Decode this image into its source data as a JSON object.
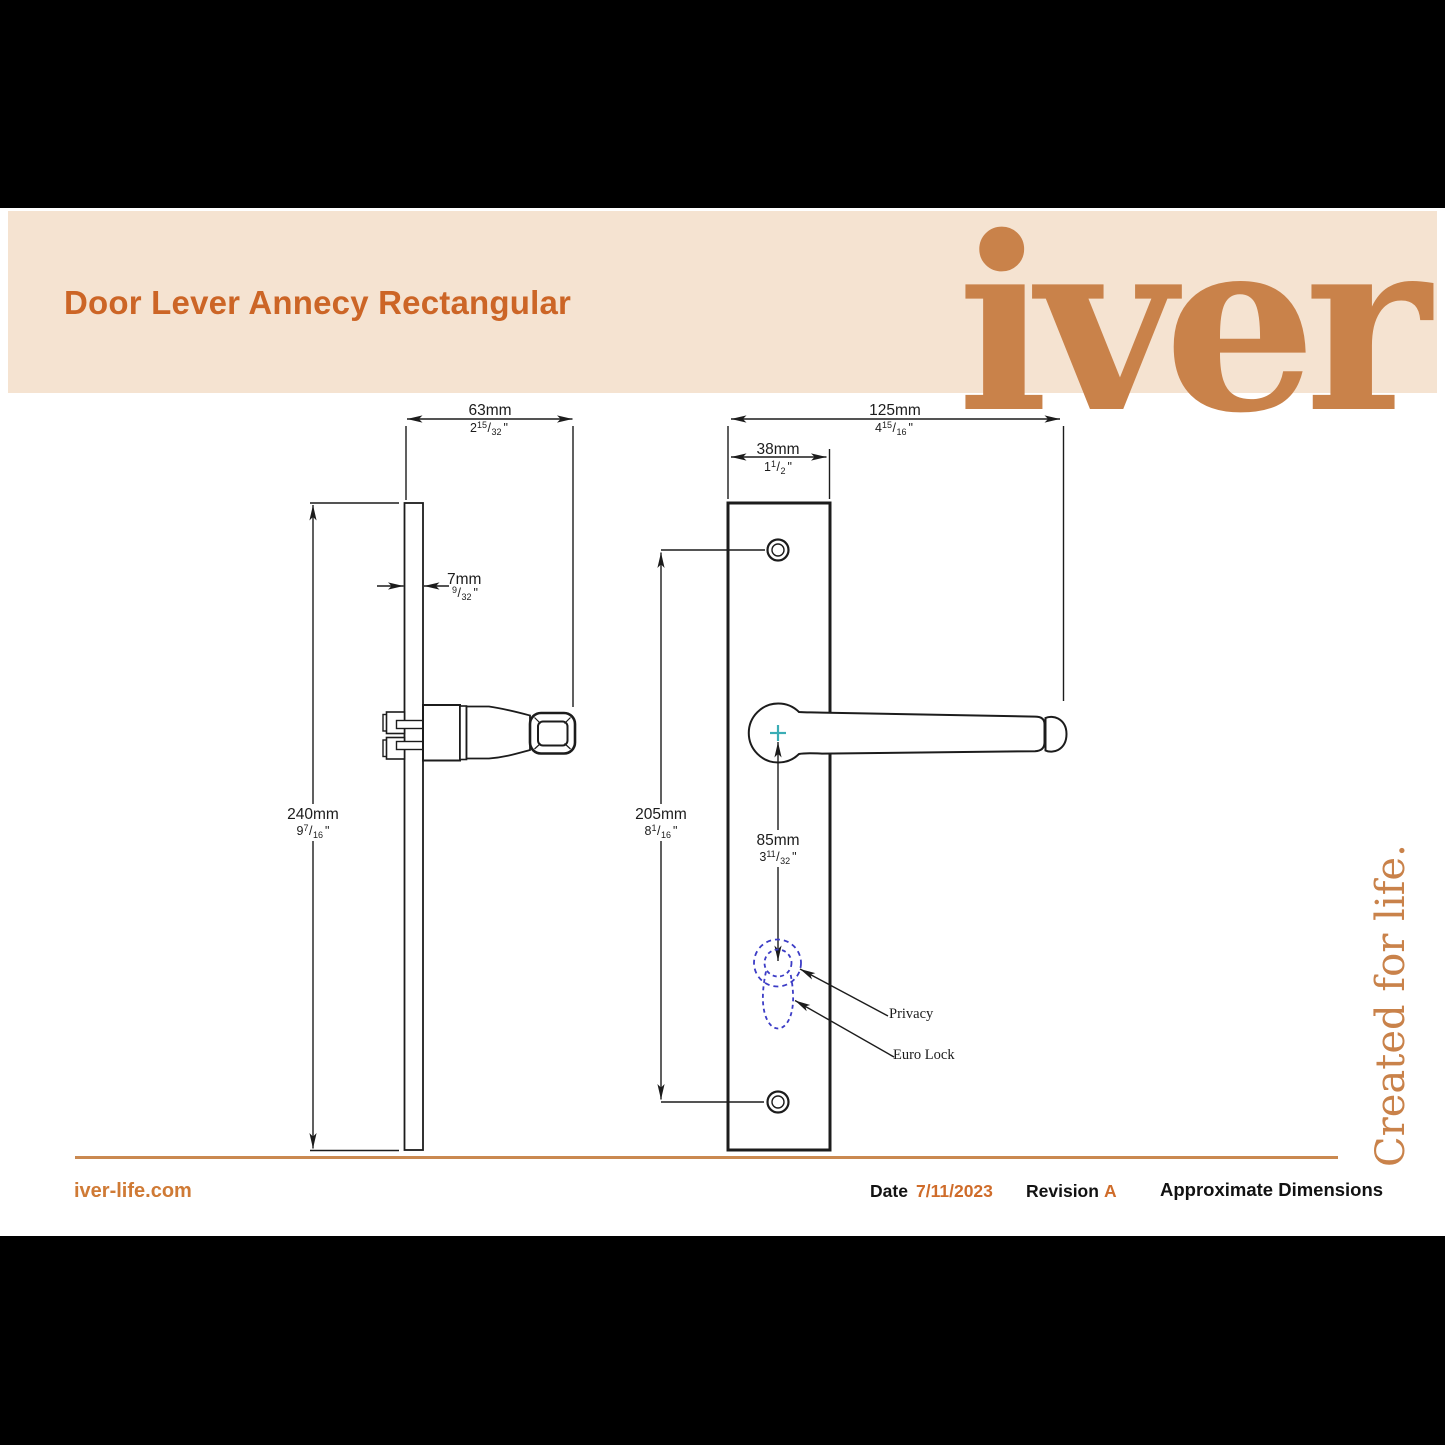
{
  "header": {
    "title": "Door Lever Annecy Rectangular",
    "brand_logo": "iver"
  },
  "tagline": "Created for life.",
  "units": {
    "inch": "\"",
    "slash": "/"
  },
  "dimensions": {
    "side_width": {
      "metric": "63mm",
      "whole": "2",
      "num": "15",
      "den": "32"
    },
    "plate_thickness": {
      "metric": "7mm",
      "whole": "",
      "num": "9",
      "den": "32"
    },
    "plate_height": {
      "metric": "240mm",
      "whole": "9",
      "num": "7",
      "den": "16"
    },
    "front_width": {
      "metric": "125mm",
      "whole": "4",
      "num": "15",
      "den": "16"
    },
    "front_plate_width": {
      "metric": "38mm",
      "whole": "1",
      "num": "1",
      "den": "2"
    },
    "hole_spacing": {
      "metric": "205mm",
      "whole": "8",
      "num": "1",
      "den": "16"
    },
    "lock_offset": {
      "metric": "85mm",
      "whole": "3",
      "num": "11",
      "den": "32"
    }
  },
  "callouts": {
    "privacy": "Privacy",
    "euro_lock": "Euro Lock"
  },
  "footer": {
    "website": "iver-life.com",
    "date_label": "Date",
    "date_value": "7/11/2023",
    "revision_label": "Revision",
    "revision_value": "A",
    "note": "Approximate Dimensions"
  },
  "colors": {
    "title_orange": "#cc6526",
    "brand_orange": "#c9824a",
    "band_beige": "#f5e3d1",
    "dashed_blue": "#3c3cc6",
    "teal_cross": "#3aadb5",
    "rule_orange": "#ca8950"
  }
}
